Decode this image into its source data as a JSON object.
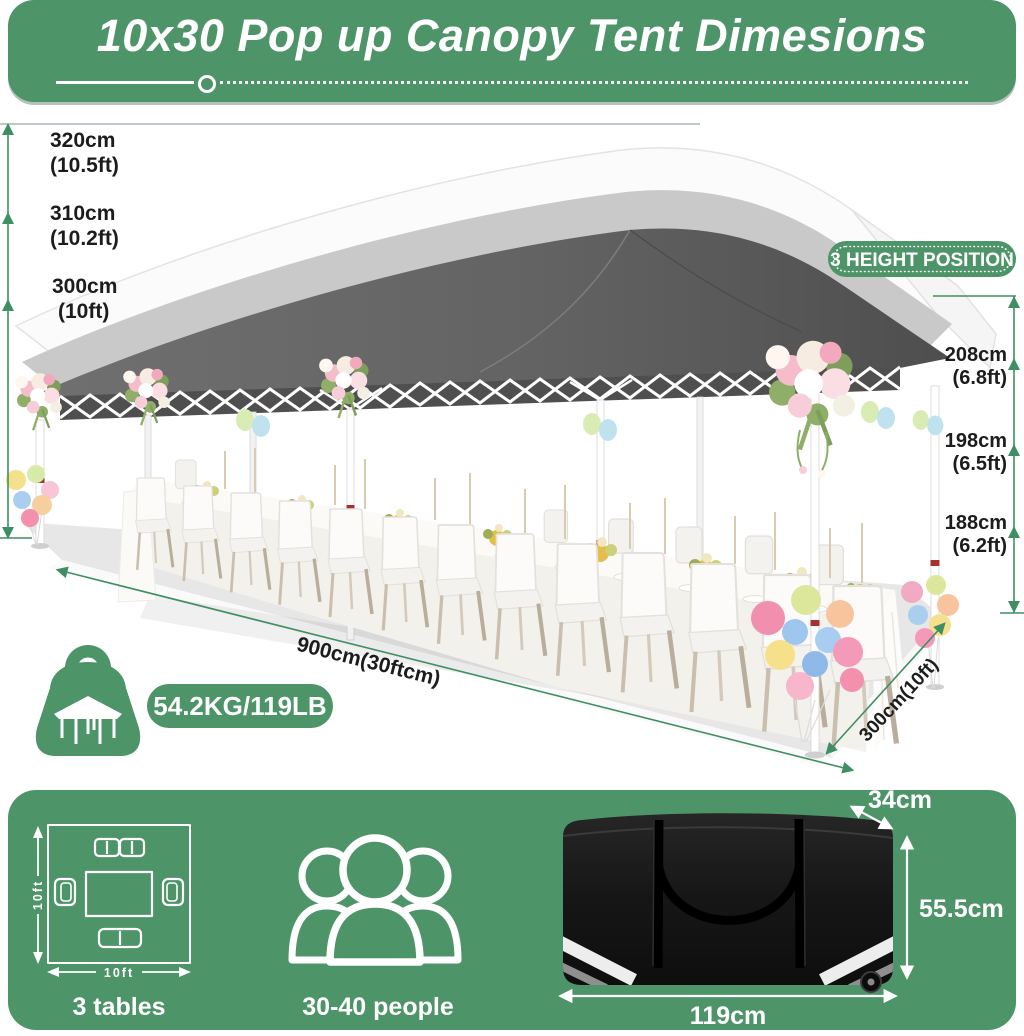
{
  "header": {
    "title": "10x30 Pop up Canopy Tent Dimesions"
  },
  "scene": {
    "badge": "3 HEIGHT POSITION",
    "weight": "54.2KG/119LB",
    "length": "900cm(30ftcm)",
    "depth": "300cm(10ft)",
    "heights_left": [
      {
        "cm": "320cm",
        "ft": "(10.5ft)"
      },
      {
        "cm": "310cm",
        "ft": "(10.2ft)"
      },
      {
        "cm": "300cm",
        "ft": "(10ft)"
      }
    ],
    "heights_right": [
      {
        "cm": "208cm",
        "ft": "(6.8ft)"
      },
      {
        "cm": "198cm",
        "ft": "(6.5ft)"
      },
      {
        "cm": "188cm",
        "ft": "(6.2ft)"
      }
    ]
  },
  "footer": {
    "tables_caption": "3 tables",
    "tables_w": "10ft",
    "tables_h": "10ft",
    "people_caption": "30-40 people",
    "bag": {
      "depth": "34cm",
      "height": "55.5cm",
      "width": "119cm"
    }
  },
  "icons": {
    "weight": "weight-kettlebell-icon",
    "people": "people-group-icon",
    "tables": "table-layout-icon",
    "bag": "carry-bag-graphic"
  },
  "colors": {
    "brand_green": "#4d9468",
    "measure_green": "#3e8f63",
    "canopy_dark": "#5f5f5f",
    "canopy_mid": "#c9c9c9",
    "canopy_light": "#f7f7f7",
    "bag_black": "#161616",
    "text_dark": "#1c1c1c"
  }
}
